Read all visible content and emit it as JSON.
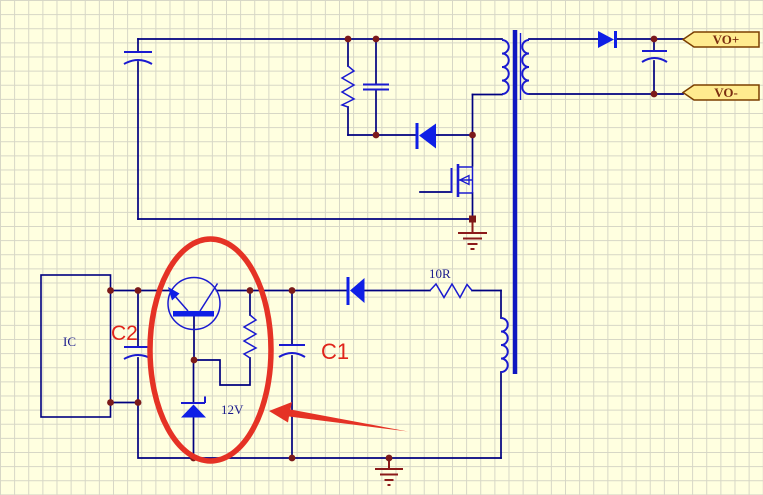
{
  "colors": {
    "background": "#FFFFE0",
    "grid_line": "#D6D6C6",
    "wire": "#000080",
    "component_stroke": "#1A1AD0",
    "component_fill": "#0F1FE6",
    "junction_dot": "#7C1A1A",
    "ground": "#8B1A1A",
    "port_fill": "#FFEB8F",
    "port_border": "#7B3F00",
    "port_text": "#7C2E10",
    "value_text": "#1A1A8C",
    "annotation_red": "#E53225"
  },
  "schematic": {
    "ports": [
      {
        "label": "VO+"
      },
      {
        "label": "VO-"
      }
    ],
    "component_labels": {
      "aux_resistor": "10R",
      "zener_diode": "12V",
      "ic_block": "IC"
    },
    "annotations": {
      "capacitor_marked_c2": "C2",
      "capacitor_marked_c1": "C1"
    }
  }
}
